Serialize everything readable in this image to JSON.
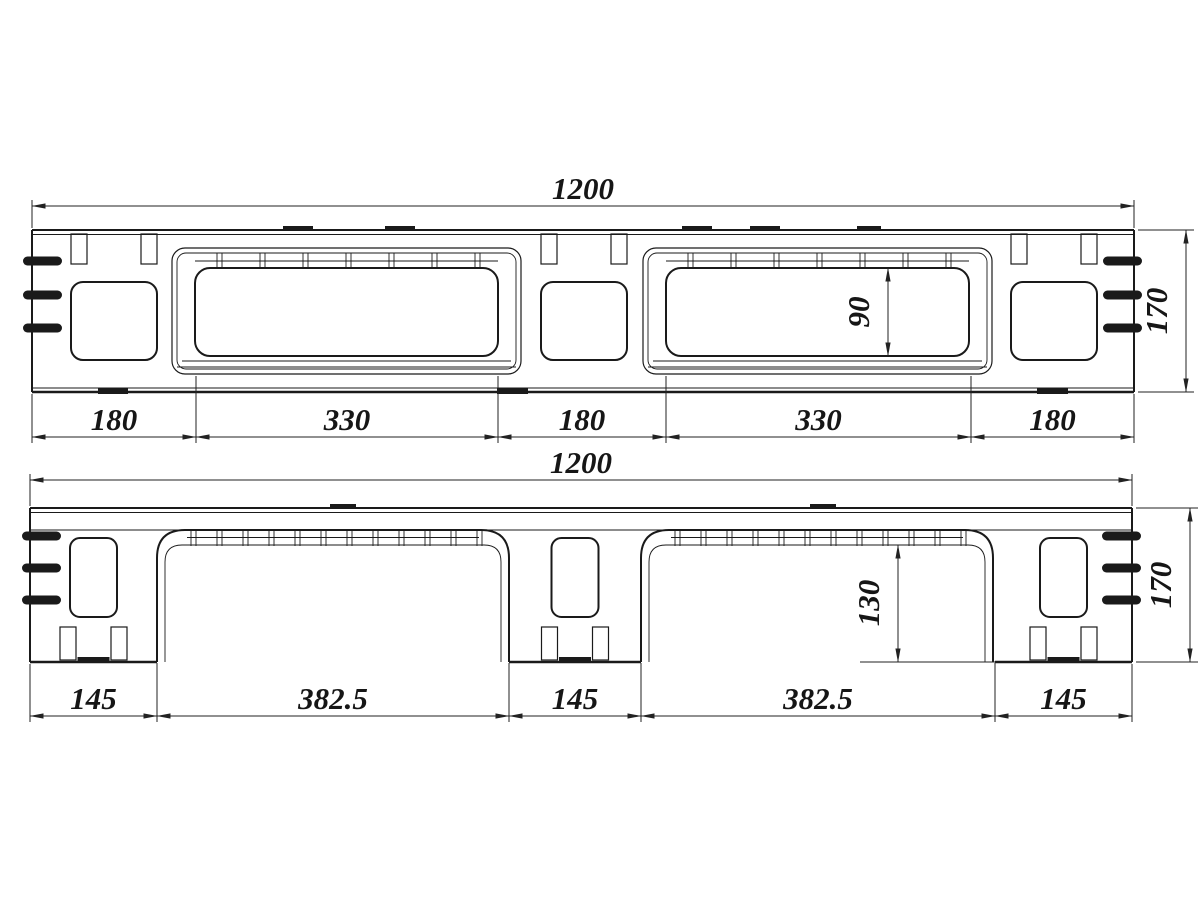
{
  "drawing": {
    "views": {
      "top": {
        "label": "upper-side-view",
        "dim_overall": "1200",
        "dim_height": "170",
        "dim_window_height": "90",
        "chain": [
          "180",
          "330",
          "180",
          "330",
          "180"
        ]
      },
      "bottom": {
        "label": "lower-side-view",
        "dim_overall": "1200",
        "dim_height": "170",
        "dim_leg_height": "130",
        "chain": [
          "145",
          "382.5",
          "145",
          "382.5",
          "145"
        ]
      }
    },
    "style": {
      "line_color": "#1a1a1a",
      "background": "#ffffff"
    }
  }
}
